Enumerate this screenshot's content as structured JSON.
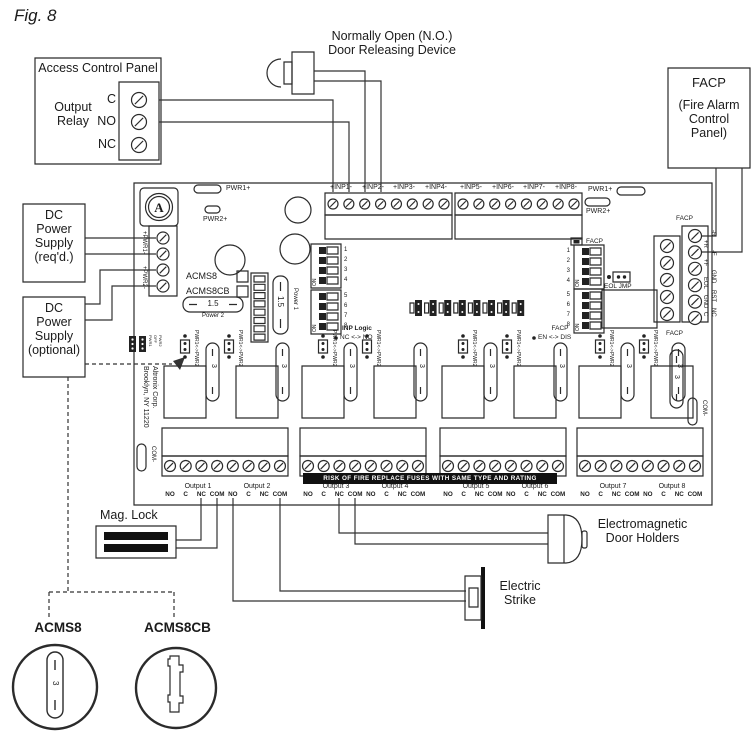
{
  "fig_label": "Fig. 8",
  "access_panel": {
    "title": "Access Control Panel",
    "relay_label": "Output\nRelay",
    "terminals": [
      "C",
      "NO",
      "NC"
    ]
  },
  "door_device": {
    "label": "Normally Open (N.O.)\nDoor Releasing Device"
  },
  "facp_box": {
    "title": "FACP",
    "subtitle": "(Fire Alarm\nControl\nPanel)"
  },
  "dc_required": {
    "label": "DC\nPower\nSupply\n(req'd.)"
  },
  "dc_optional": {
    "label": "DC\nPower\nSupply\n(optional)"
  },
  "board": {
    "pwr1_led": "PWR1+",
    "pwr2_led": "PWR2+",
    "inputs": [
      "+INP1-",
      "+INP2-",
      "+INP3-",
      "+INP4-",
      "+INP5-",
      "+INP6-",
      "+INP7-",
      "+INP8-"
    ],
    "pwr_terminals": [
      "+PWR1-",
      "+PWR2-"
    ],
    "model_checks": [
      "ACMS8",
      "ACMS8CB"
    ],
    "power_fuses": {
      "rating": "1.5",
      "power1": "Power 1",
      "power2": "Power 2"
    },
    "dip_numbers": [
      "1",
      "2",
      "3",
      "4",
      "5",
      "6",
      "7",
      "8"
    ],
    "dip_on": "ON",
    "inp_logic": {
      "title": "INP Logic",
      "range": "NC <-> NO"
    },
    "facp_dip": {
      "title": "FACP",
      "range": "EN <-> DIS"
    },
    "facp_led": "FACP",
    "eol_jmp": "EOL JMP",
    "facp_strip_top": "FACP",
    "facp_strip_bottom": "FACP",
    "facp_terminals_outer": [
      "-R",
      "-F",
      "GND",
      "RST",
      "NC"
    ],
    "facp_terminals_inner": [
      "+R",
      "+F",
      "EOL",
      "GND",
      "C"
    ],
    "pwr_select": "PWR1<->PWR2",
    "pwr_jumper_small": [
      "PWR1",
      "OFF",
      "PWR2"
    ],
    "channel_fuse_rating": "3",
    "com_minus": "COM-",
    "mfr_line1": "Altronix Corp.",
    "mfr_line2": "Brooklyn, NY 11220",
    "warning": "RISK OF FIRE REPLACE FUSES WITH SAME TYPE AND RATING",
    "outputs": [
      "Output 1",
      "Output 2",
      "Output 3",
      "Output 4",
      "Output 5",
      "Output 6",
      "Output 7",
      "Output 8"
    ],
    "output_terminals": [
      "NO",
      "C",
      "NC",
      "COM"
    ]
  },
  "devices": {
    "mag_lock": "Mag. Lock",
    "em_holders": "Electromagnetic\nDoor Holders",
    "electric_strike": "Electric\nStrike"
  },
  "legend": {
    "acms8": "ACMS8",
    "acms8cb": "ACMS8CB"
  }
}
